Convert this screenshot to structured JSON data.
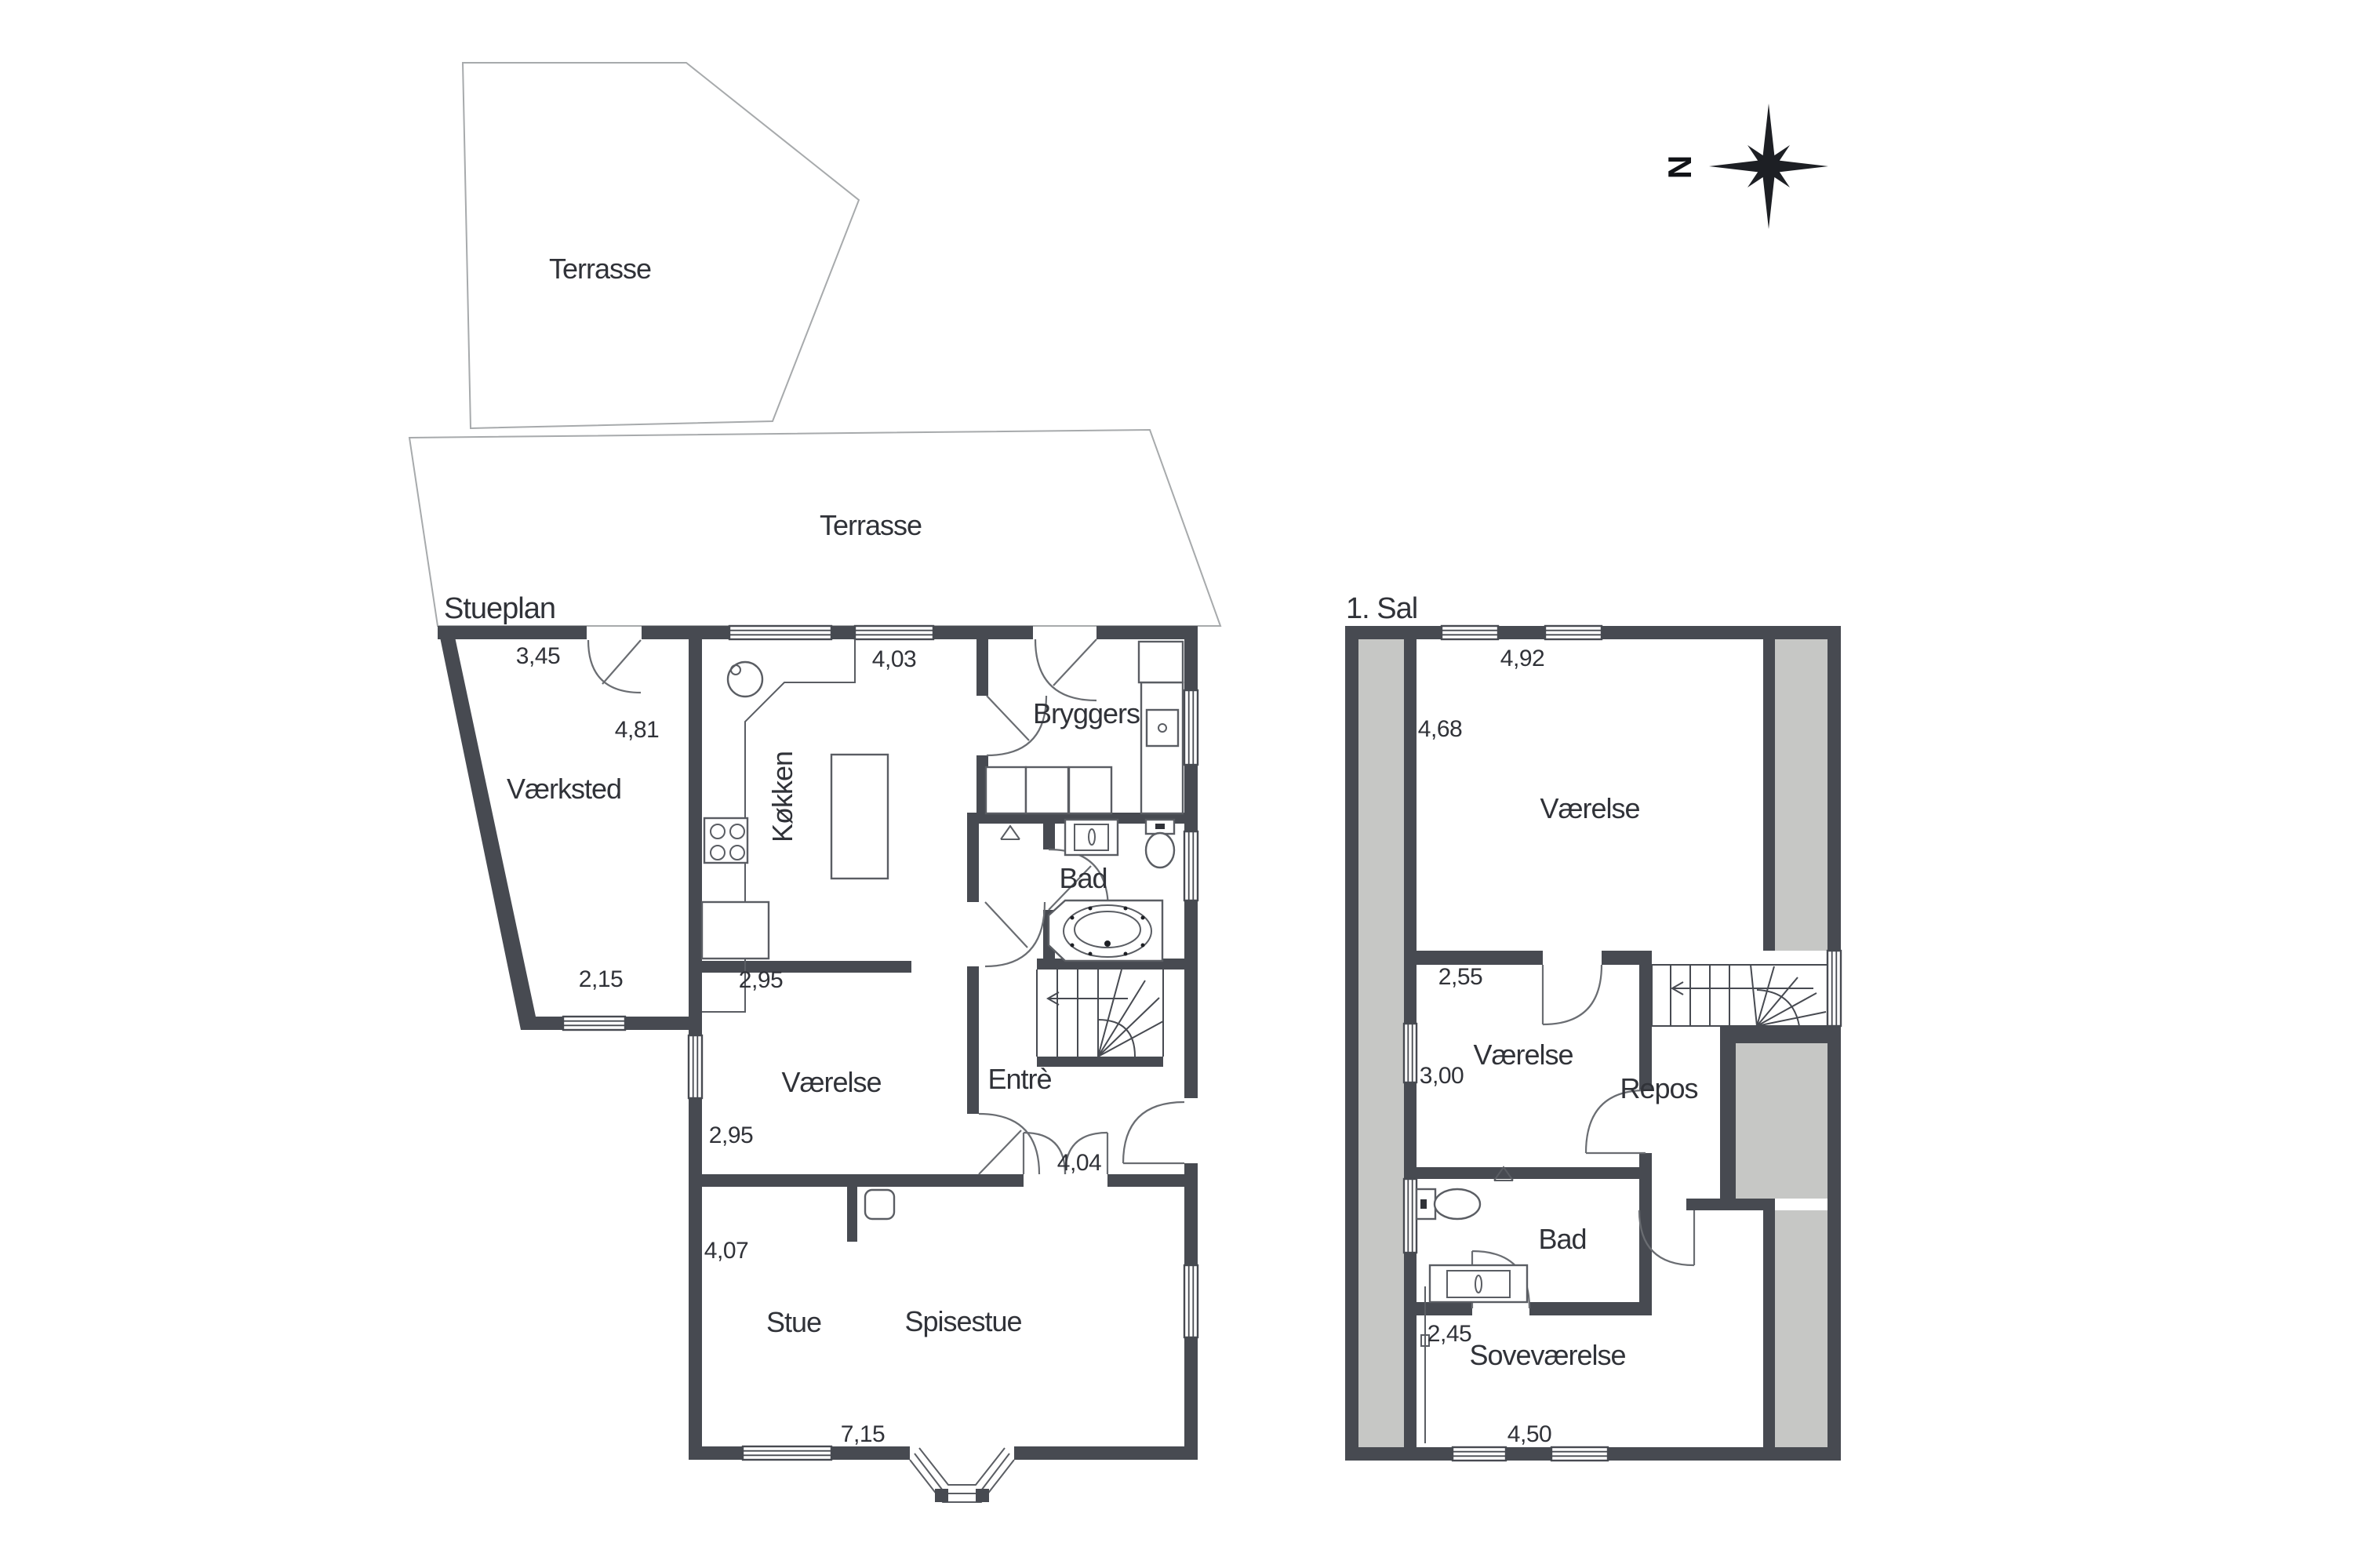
{
  "titles": {
    "ground": "Stueplan",
    "first": "1. Sal"
  },
  "compass": {
    "north": "N"
  },
  "terrace": {
    "upper": "Terrasse",
    "lower": "Terrasse"
  },
  "colors": {
    "wall": "#474a51",
    "sloped_ceiling_fill": "#c6c7c5",
    "background": "#ffffff"
  },
  "ground": {
    "rooms": {
      "vaerksted": "Værksted",
      "koekken": "Køkken",
      "bryggers": "Bryggers",
      "bad": "Bad",
      "entre": "Entrè",
      "vaerelse": "Værelse",
      "stue": "Stue",
      "spisestue": "Spisestue"
    },
    "dims": {
      "d345": "3,45",
      "d481": "4,81",
      "d403": "4,03",
      "d215": "2,15",
      "d295a": "2,95",
      "d295b": "2,95",
      "d407": "4,07",
      "d404": "4,04",
      "d715": "7,15"
    }
  },
  "first": {
    "rooms": {
      "vaerelse_stor": "Værelse",
      "vaerelse": "Værelse",
      "repos": "Repos",
      "bad": "Bad",
      "sovevaerelse": "Soveværelse"
    },
    "dims": {
      "d492": "4,92",
      "d468": "4,68",
      "d255": "2,55",
      "d300": "3,00",
      "d245": "2,45",
      "d450": "4,50"
    }
  }
}
